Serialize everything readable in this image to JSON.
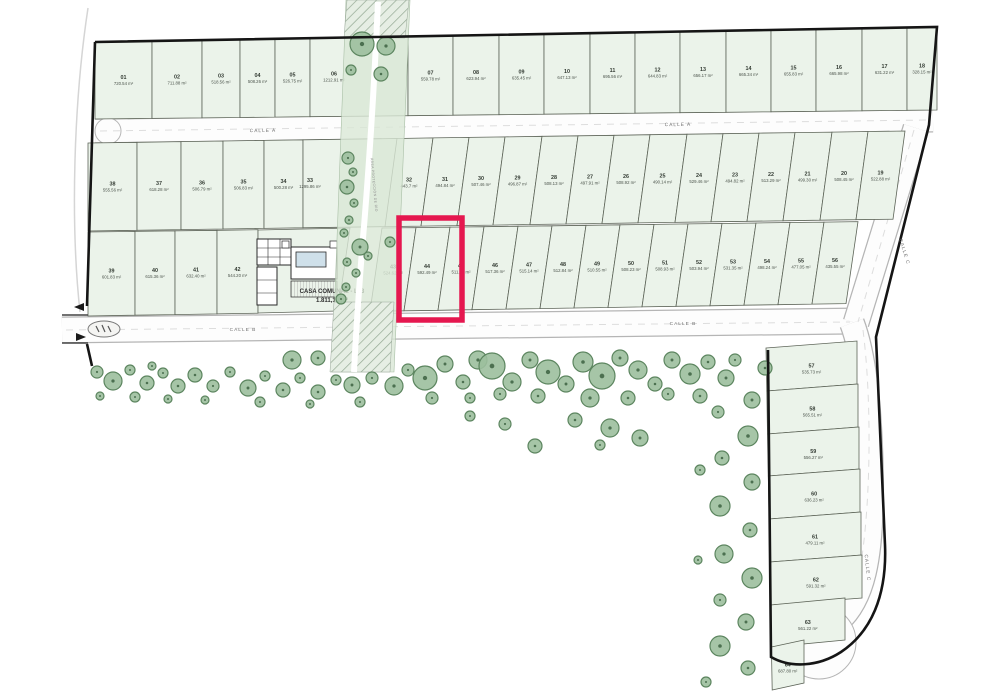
{
  "plan_title": "Plano de lotificación",
  "streets": {
    "calle_a": "CALLE A",
    "calle_b": "CALLE B",
    "calle_c": "CALLE C"
  },
  "strip": {
    "label": "ÁREA PROTECCIÓN DE RÍO"
  },
  "casa_comunal": {
    "label": "CASA COMUNAL - L03",
    "area": "1.811,10 m²"
  },
  "highlight": {
    "lot": "44",
    "color": "#e5174f"
  },
  "colors": {
    "lot_fill": "#ebf3ea",
    "lot_border": "#5d6458",
    "street_fill": "#fdfdfd",
    "street_border": "#b5b5b5",
    "tree_fill": "#9cbf9d",
    "tree_stroke": "#5c855f",
    "tree_dot": "#4c7050",
    "strip_fill": "#d9e7d6",
    "boundary": "#151515"
  },
  "lots": {
    "row1": [
      {
        "n": "01",
        "a": "720.54 m²"
      },
      {
        "n": "02",
        "a": "711.88 m²"
      },
      {
        "n": "03",
        "a": "518.56 m²"
      },
      {
        "n": "04",
        "a": "508.26 m²"
      },
      {
        "n": "05",
        "a": "526.75 m²"
      },
      {
        "n": "06",
        "a": "1212.91 m²"
      },
      {
        "n": "07",
        "a": "559.78 m²"
      },
      {
        "n": "08",
        "a": "623.94 m²"
      },
      {
        "n": "09",
        "a": "635.45 m²"
      },
      {
        "n": "10",
        "a": "647.13 m²"
      },
      {
        "n": "11",
        "a": "695.56 m²"
      },
      {
        "n": "12",
        "a": "644.83 m²"
      },
      {
        "n": "13",
        "a": "656.17 m²"
      },
      {
        "n": "14",
        "a": "665.34 m²"
      },
      {
        "n": "15",
        "a": "655.83 m²"
      },
      {
        "n": "16",
        "a": "665.98 m²"
      },
      {
        "n": "17",
        "a": "631.22 m²"
      },
      {
        "n": "18",
        "a": "328.15 m²"
      }
    ],
    "row2_left": [
      {
        "n": "38",
        "a": "555.56 m²"
      },
      {
        "n": "37",
        "a": "618.28 m²"
      },
      {
        "n": "36",
        "a": "506.79 m²"
      },
      {
        "n": "35",
        "a": "506.83 m²"
      },
      {
        "n": "34",
        "a": "500.28 m²"
      },
      {
        "n": "33",
        "a": "1295.86 m²"
      }
    ],
    "row2_right": [
      {
        "n": "32",
        "a": "443.7 m²"
      },
      {
        "n": "31",
        "a": "494.84 m²"
      },
      {
        "n": "30",
        "a": "507.46 m²"
      },
      {
        "n": "29",
        "a": "496.87 m²"
      },
      {
        "n": "28",
        "a": "508.13 m²"
      },
      {
        "n": "27",
        "a": "497.91 m²"
      },
      {
        "n": "26",
        "a": "508.92 m²"
      },
      {
        "n": "25",
        "a": "490.14 m²"
      },
      {
        "n": "24",
        "a": "529.46 m²"
      },
      {
        "n": "23",
        "a": "494.82 m²"
      },
      {
        "n": "22",
        "a": "513.29 m²"
      },
      {
        "n": "21",
        "a": "499.30 m²"
      },
      {
        "n": "20",
        "a": "508.45 m²"
      },
      {
        "n": "19",
        "a": "522.88 m²"
      }
    ],
    "row3_left": [
      {
        "n": "39",
        "a": "601.83 m²"
      },
      {
        "n": "40",
        "a": "615.36 m²"
      },
      {
        "n": "41",
        "a": "632.40 m²"
      },
      {
        "n": "42",
        "a": "544.20 m²"
      }
    ],
    "row3_right": [
      {
        "n": "43",
        "a": "524.62 m²"
      },
      {
        "n": "44",
        "a": "592.49 m²"
      },
      {
        "n": "45",
        "a": "511.74 m²"
      },
      {
        "n": "46",
        "a": "517.36 m²"
      },
      {
        "n": "47",
        "a": "515.14 m²"
      },
      {
        "n": "48",
        "a": "512.84 m²"
      },
      {
        "n": "49",
        "a": "510.55 m²"
      },
      {
        "n": "50",
        "a": "508.23 m²"
      },
      {
        "n": "51",
        "a": "508.93 m²"
      },
      {
        "n": "52",
        "a": "503.94 m²"
      },
      {
        "n": "53",
        "a": "531.35 m²"
      },
      {
        "n": "54",
        "a": "498.24 m²"
      },
      {
        "n": "55",
        "a": "477.05 m²"
      },
      {
        "n": "56",
        "a": "435.55 m²"
      }
    ],
    "east_column": [
      {
        "n": "57",
        "a": "535.73 m²"
      },
      {
        "n": "58",
        "a": "565.51 m²"
      },
      {
        "n": "59",
        "a": "556.27 m²"
      },
      {
        "n": "60",
        "a": "636.23 m²"
      },
      {
        "n": "61",
        "a": "479.11 m²"
      },
      {
        "n": "62",
        "a": "591.32 m²"
      },
      {
        "n": "63",
        "a": "561.22 m²"
      },
      {
        "n": "64",
        "a": "687.80 m²"
      }
    ]
  },
  "trees": [
    [
      362,
      44,
      12
    ],
    [
      386,
      46,
      9
    ],
    [
      381,
      74,
      7
    ],
    [
      351,
      70,
      5
    ],
    [
      348,
      158,
      6
    ],
    [
      353,
      172,
      4
    ],
    [
      347,
      187,
      7
    ],
    [
      354,
      203,
      4
    ],
    [
      349,
      220,
      4
    ],
    [
      344,
      233,
      4
    ],
    [
      360,
      247,
      8
    ],
    [
      347,
      262,
      4
    ],
    [
      356,
      273,
      4
    ],
    [
      368,
      256,
      4
    ],
    [
      390,
      242,
      5
    ],
    [
      346,
      287,
      4
    ],
    [
      341,
      299,
      5
    ],
    [
      97,
      372,
      6
    ],
    [
      113,
      381,
      9
    ],
    [
      130,
      370,
      5
    ],
    [
      147,
      383,
      7
    ],
    [
      163,
      373,
      5
    ],
    [
      178,
      386,
      7
    ],
    [
      100,
      396,
      4
    ],
    [
      135,
      397,
      5
    ],
    [
      168,
      399,
      4
    ],
    [
      152,
      366,
      4
    ],
    [
      195,
      375,
      7
    ],
    [
      213,
      386,
      6
    ],
    [
      230,
      372,
      5
    ],
    [
      248,
      388,
      8
    ],
    [
      265,
      376,
      5
    ],
    [
      283,
      390,
      7
    ],
    [
      300,
      378,
      5
    ],
    [
      318,
      392,
      7
    ],
    [
      336,
      380,
      5
    ],
    [
      205,
      400,
      4
    ],
    [
      260,
      402,
      5
    ],
    [
      310,
      404,
      4
    ],
    [
      292,
      360,
      9
    ],
    [
      318,
      358,
      7
    ],
    [
      352,
      385,
      8
    ],
    [
      372,
      378,
      6
    ],
    [
      394,
      386,
      9
    ],
    [
      408,
      370,
      6
    ],
    [
      360,
      402,
      5
    ],
    [
      425,
      378,
      12
    ],
    [
      445,
      364,
      8
    ],
    [
      463,
      382,
      7
    ],
    [
      478,
      360,
      9
    ],
    [
      432,
      398,
      6
    ],
    [
      470,
      398,
      5
    ],
    [
      492,
      366,
      13
    ],
    [
      512,
      382,
      9
    ],
    [
      530,
      360,
      8
    ],
    [
      548,
      372,
      12
    ],
    [
      500,
      394,
      6
    ],
    [
      538,
      396,
      7
    ],
    [
      566,
      384,
      8
    ],
    [
      583,
      362,
      10
    ],
    [
      602,
      376,
      13
    ],
    [
      620,
      358,
      8
    ],
    [
      638,
      370,
      9
    ],
    [
      655,
      384,
      7
    ],
    [
      590,
      398,
      9
    ],
    [
      628,
      398,
      7
    ],
    [
      575,
      420,
      7
    ],
    [
      610,
      428,
      9
    ],
    [
      640,
      438,
      8
    ],
    [
      600,
      445,
      5
    ],
    [
      505,
      424,
      6
    ],
    [
      535,
      446,
      7
    ],
    [
      470,
      416,
      5
    ],
    [
      672,
      360,
      8
    ],
    [
      690,
      374,
      10
    ],
    [
      708,
      362,
      7
    ],
    [
      726,
      378,
      8
    ],
    [
      668,
      394,
      6
    ],
    [
      700,
      396,
      7
    ],
    [
      735,
      360,
      6
    ],
    [
      765,
      368,
      7
    ],
    [
      752,
      400,
      8
    ],
    [
      718,
      412,
      6
    ],
    [
      748,
      436,
      10
    ],
    [
      722,
      458,
      7
    ],
    [
      752,
      482,
      8
    ],
    [
      720,
      506,
      10
    ],
    [
      750,
      530,
      7
    ],
    [
      724,
      554,
      9
    ],
    [
      752,
      578,
      10
    ],
    [
      720,
      600,
      6
    ],
    [
      746,
      622,
      8
    ],
    [
      720,
      646,
      10
    ],
    [
      748,
      668,
      7
    ],
    [
      706,
      682,
      5
    ],
    [
      700,
      470,
      5
    ],
    [
      698,
      560,
      4
    ]
  ]
}
